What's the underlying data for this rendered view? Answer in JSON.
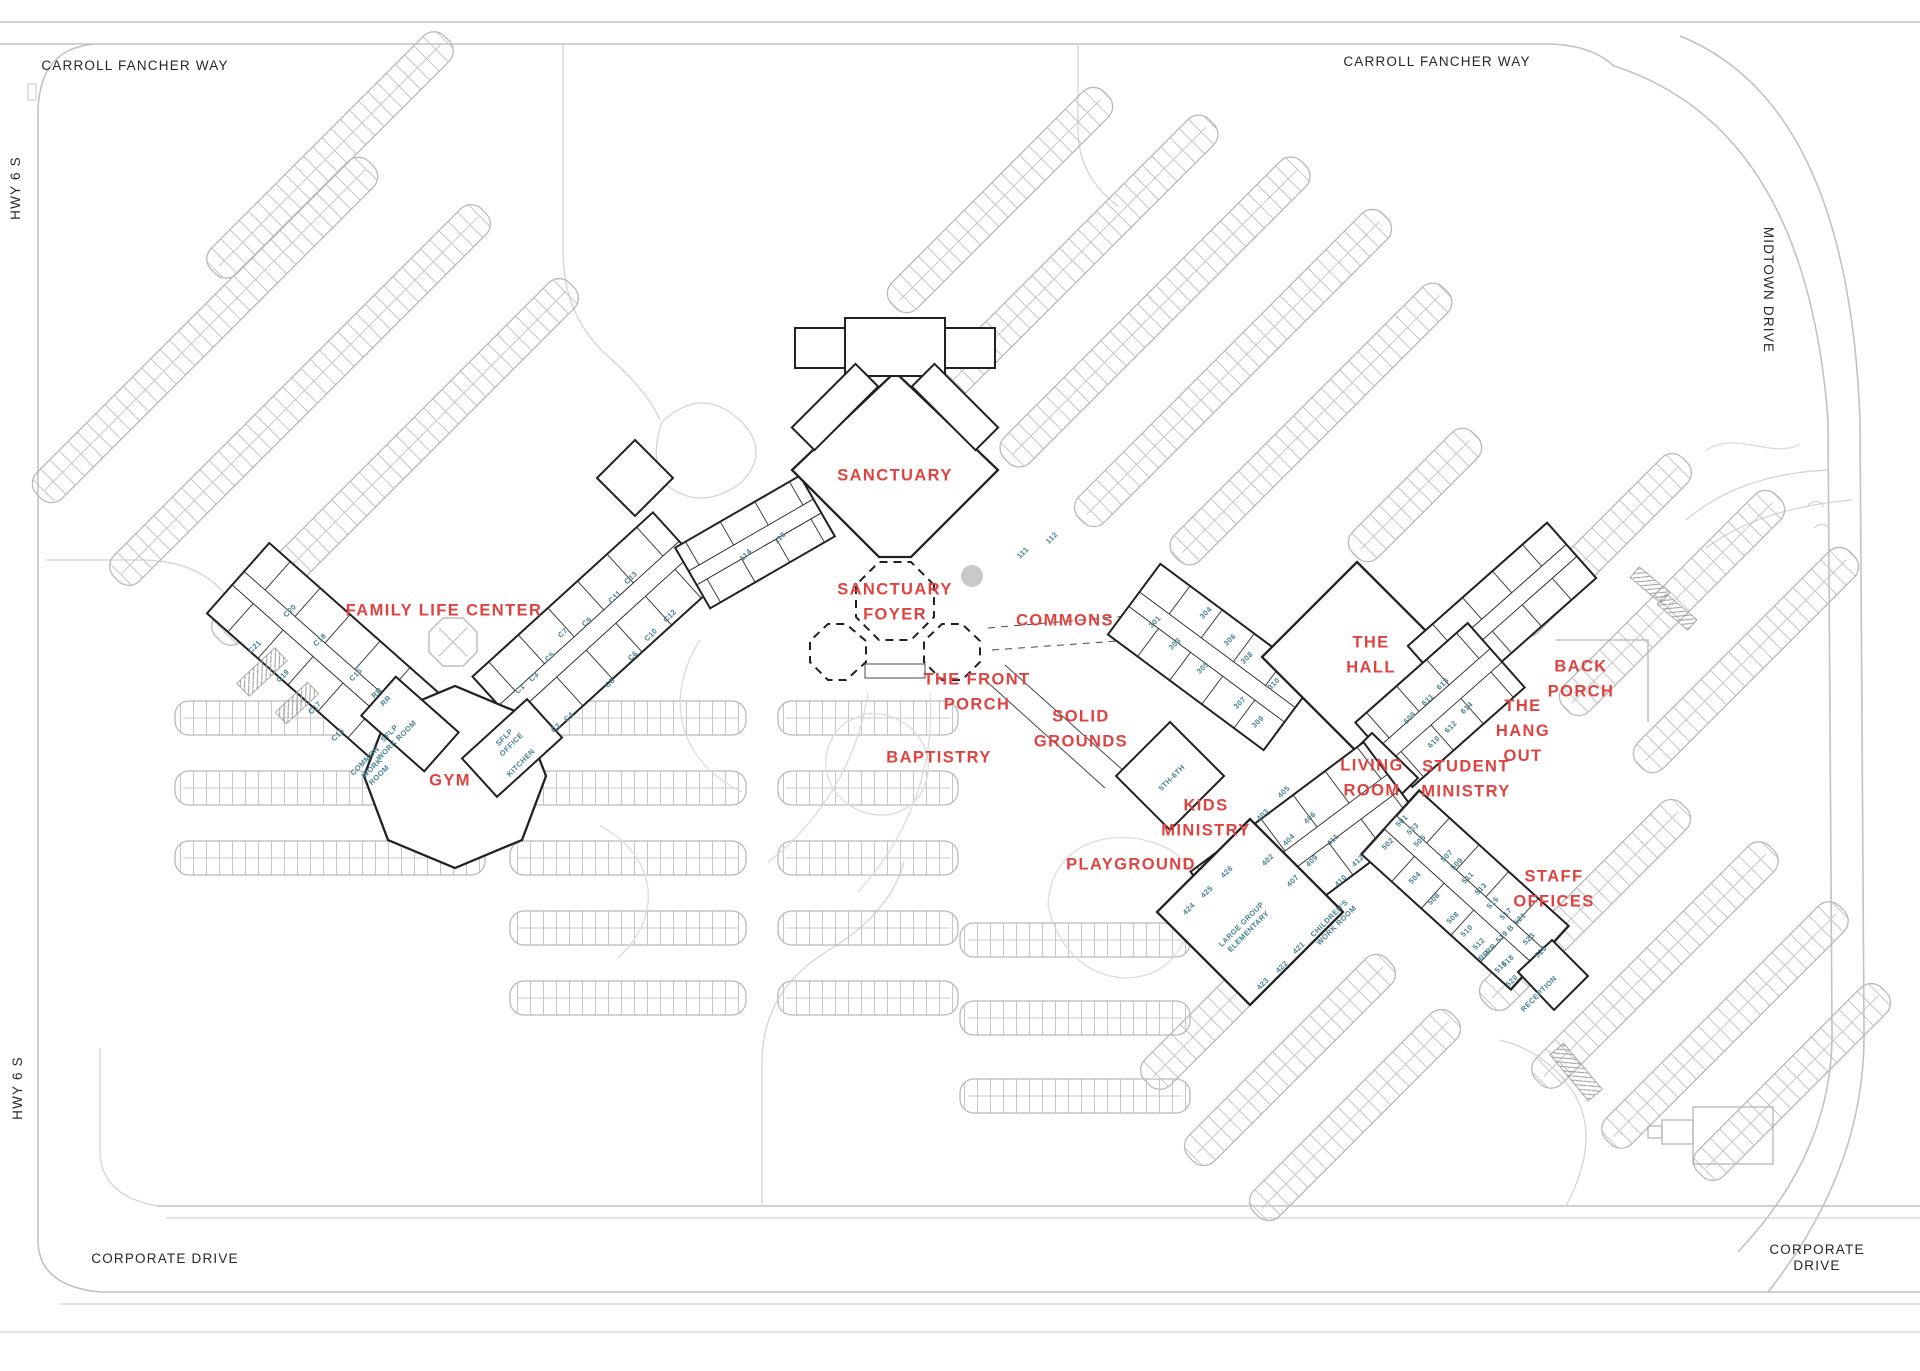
{
  "map_title": "Church Campus Site Plan",
  "colors": {
    "area_label": "#df4340",
    "room_label": "#47818f",
    "street_label": "#262626",
    "building_line": "#212121",
    "parking_line": "#b9b9b9",
    "road_line": "#c2c2c2"
  },
  "street_labels": [
    {
      "id": "carroll-fancher-way-west",
      "text": "CARROLL FANCHER WAY",
      "x": 135,
      "y": 66,
      "r": 0
    },
    {
      "id": "carroll-fancher-way-east",
      "text": "CARROLL FANCHER WAY",
      "x": 1437,
      "y": 62,
      "r": 0
    },
    {
      "id": "midtown-drive",
      "text": "MIDTOWN DRIVE",
      "x": 1768,
      "y": 290,
      "r": 90
    },
    {
      "id": "hwy-6-s-north",
      "text": "HWY 6 S",
      "x": 16,
      "y": 188,
      "r": -90
    },
    {
      "id": "hwy-6-s-south",
      "text": "HWY 6 S",
      "x": 18,
      "y": 1088,
      "r": -90
    },
    {
      "id": "corporate-drive-west",
      "text": "CORPORATE DRIVE",
      "x": 165,
      "y": 1259,
      "r": 0
    },
    {
      "id": "corporate-drive-east",
      "text": "CORPORATE DRIVE",
      "x": 1817,
      "y": 1258,
      "r": 0
    }
  ],
  "area_labels": [
    {
      "id": "sanctuary",
      "text": "SANCTUARY",
      "x": 895,
      "y": 476,
      "r": 0
    },
    {
      "id": "sanctuary-foyer",
      "text": "SANCTUARY\nFOYER",
      "x": 895,
      "y": 602,
      "r": 0
    },
    {
      "id": "family-life-center",
      "text": "FAMILY LIFE CENTER",
      "x": 444,
      "y": 611,
      "r": 0
    },
    {
      "id": "gym",
      "text": "GYM",
      "x": 450,
      "y": 781,
      "r": 0
    },
    {
      "id": "commons",
      "text": "COMMONS",
      "x": 1065,
      "y": 621,
      "r": 0
    },
    {
      "id": "the-front-porch",
      "text": "THE FRONT\nPORCH",
      "x": 977,
      "y": 692,
      "r": 0
    },
    {
      "id": "solid-grounds",
      "text": "SOLID\nGROUNDS",
      "x": 1081,
      "y": 729,
      "r": 0
    },
    {
      "id": "baptistry",
      "text": "BAPTISTRY",
      "x": 939,
      "y": 758,
      "r": 0
    },
    {
      "id": "kids-ministry",
      "text": "KIDS\nMINISTRY",
      "x": 1206,
      "y": 818,
      "r": 0
    },
    {
      "id": "playground",
      "text": "PLAYGROUND",
      "x": 1131,
      "y": 865,
      "r": 0
    },
    {
      "id": "the-hall",
      "text": "THE\nHALL",
      "x": 1371,
      "y": 655,
      "r": 0
    },
    {
      "id": "living-room",
      "text": "LIVING\nROOM",
      "x": 1372,
      "y": 778,
      "r": 0
    },
    {
      "id": "student-ministry",
      "text": "STUDENT\nMINISTRY",
      "x": 1466,
      "y": 779,
      "r": 0
    },
    {
      "id": "the-hang-out",
      "text": "THE\nHANG\nOUT",
      "x": 1523,
      "y": 731,
      "r": 0
    },
    {
      "id": "back-porch",
      "text": "BACK\nPORCH",
      "x": 1581,
      "y": 679,
      "r": 0
    },
    {
      "id": "staff-offices",
      "text": "STAFF\nOFFICES",
      "x": 1554,
      "y": 889,
      "r": 0
    }
  ],
  "room_labels": [
    {
      "id": "c20",
      "text": "C20",
      "x": 290,
      "y": 611,
      "r": -45
    },
    {
      "id": "c21",
      "text": "C21",
      "x": 255,
      "y": 647,
      "r": -45
    },
    {
      "id": "c18",
      "text": "C18",
      "x": 320,
      "y": 640,
      "r": -45
    },
    {
      "id": "c19",
      "text": "C19",
      "x": 283,
      "y": 676,
      "r": -45
    },
    {
      "id": "c16",
      "text": "C16",
      "x": 356,
      "y": 675,
      "r": -45
    },
    {
      "id": "c17",
      "text": "C17",
      "x": 315,
      "y": 708,
      "r": -45
    },
    {
      "id": "c15",
      "text": "C15",
      "x": 338,
      "y": 735,
      "r": -45
    },
    {
      "id": "rr-1",
      "text": "RR",
      "x": 377,
      "y": 693,
      "r": -45
    },
    {
      "id": "rr-2",
      "text": "RR",
      "x": 386,
      "y": 701,
      "r": -45
    },
    {
      "id": "sflp-work-room",
      "text": "SFLP\nWORK ROOM",
      "x": 393,
      "y": 737,
      "r": -45
    },
    {
      "id": "common-work-room",
      "text": "COMMON\nWORK\nROOM",
      "x": 372,
      "y": 768,
      "r": -45
    },
    {
      "id": "sflp-office",
      "text": "SFLP\nOFFICE",
      "x": 508,
      "y": 741,
      "r": -45
    },
    {
      "id": "kitchen",
      "text": "KITCHEN",
      "x": 521,
      "y": 763,
      "r": -45
    },
    {
      "id": "c13",
      "text": "C13",
      "x": 631,
      "y": 578,
      "r": -45
    },
    {
      "id": "c11",
      "text": "C11",
      "x": 615,
      "y": 597,
      "r": -45
    },
    {
      "id": "c9",
      "text": "C9",
      "x": 587,
      "y": 622,
      "r": -45
    },
    {
      "id": "c7",
      "text": "C7",
      "x": 563,
      "y": 633,
      "r": -45
    },
    {
      "id": "c5",
      "text": "C5",
      "x": 550,
      "y": 657,
      "r": -45
    },
    {
      "id": "c3",
      "text": "C3",
      "x": 534,
      "y": 677,
      "r": -45
    },
    {
      "id": "c1",
      "text": "C1",
      "x": 520,
      "y": 689,
      "r": -45
    },
    {
      "id": "c12",
      "text": "C12",
      "x": 670,
      "y": 616,
      "r": -45
    },
    {
      "id": "c10",
      "text": "C10",
      "x": 651,
      "y": 635,
      "r": -45
    },
    {
      "id": "c8",
      "text": "C8",
      "x": 610,
      "y": 683,
      "r": -45
    },
    {
      "id": "c6",
      "text": "C6",
      "x": 633,
      "y": 656,
      "r": -45
    },
    {
      "id": "c4",
      "text": "C4",
      "x": 569,
      "y": 717,
      "r": -45
    },
    {
      "id": "c2",
      "text": "C2",
      "x": 556,
      "y": 728,
      "r": -45
    },
    {
      "id": "room-113",
      "text": "113",
      "x": 780,
      "y": 538,
      "r": -45
    },
    {
      "id": "room-114",
      "text": "114",
      "x": 746,
      "y": 555,
      "r": -45
    },
    {
      "id": "room-111",
      "text": "111",
      "x": 1023,
      "y": 553,
      "r": -45
    },
    {
      "id": "room-112",
      "text": "112",
      "x": 1052,
      "y": 538,
      "r": -45
    },
    {
      "id": "room-301",
      "text": "301",
      "x": 1155,
      "y": 622,
      "r": -45
    },
    {
      "id": "room-303",
      "text": "303",
      "x": 1175,
      "y": 644,
      "r": -45
    },
    {
      "id": "room-305",
      "text": "305",
      "x": 1203,
      "y": 668,
      "r": -45
    },
    {
      "id": "room-307",
      "text": "307",
      "x": 1240,
      "y": 703,
      "r": -45
    },
    {
      "id": "room-309",
      "text": "309",
      "x": 1258,
      "y": 722,
      "r": -45
    },
    {
      "id": "room-304",
      "text": "304",
      "x": 1206,
      "y": 613,
      "r": -45
    },
    {
      "id": "room-306",
      "text": "306",
      "x": 1230,
      "y": 640,
      "r": -45
    },
    {
      "id": "room-308",
      "text": "308",
      "x": 1247,
      "y": 658,
      "r": -45
    },
    {
      "id": "room-310",
      "text": "310",
      "x": 1274,
      "y": 684,
      "r": -45
    },
    {
      "id": "room-609",
      "text": "609",
      "x": 1410,
      "y": 718,
      "r": -45
    },
    {
      "id": "room-611",
      "text": "611",
      "x": 1428,
      "y": 700,
      "r": -45
    },
    {
      "id": "room-613",
      "text": "613",
      "x": 1443,
      "y": 684,
      "r": -45
    },
    {
      "id": "room-610",
      "text": "610",
      "x": 1434,
      "y": 742,
      "r": -45
    },
    {
      "id": "room-612",
      "text": "612",
      "x": 1451,
      "y": 727,
      "r": -45
    },
    {
      "id": "room-614",
      "text": "614",
      "x": 1467,
      "y": 708,
      "r": -45
    },
    {
      "id": "room-5th-6th",
      "text": "5TH-6TH",
      "x": 1172,
      "y": 778,
      "r": -45
    },
    {
      "id": "room-405",
      "text": "405",
      "x": 1284,
      "y": 792,
      "r": -45
    },
    {
      "id": "room-403",
      "text": "403",
      "x": 1263,
      "y": 815,
      "r": -45
    },
    {
      "id": "room-402",
      "text": "402",
      "x": 1268,
      "y": 860,
      "r": -45
    },
    {
      "id": "room-404",
      "text": "404",
      "x": 1289,
      "y": 840,
      "r": -45
    },
    {
      "id": "room-406",
      "text": "406",
      "x": 1310,
      "y": 818,
      "r": -45
    },
    {
      "id": "room-407",
      "text": "407",
      "x": 1293,
      "y": 881,
      "r": -45
    },
    {
      "id": "room-409",
      "text": "409",
      "x": 1312,
      "y": 861,
      "r": -45
    },
    {
      "id": "room-411",
      "text": "411",
      "x": 1333,
      "y": 840,
      "r": -45
    },
    {
      "id": "room-410",
      "text": "410",
      "x": 1341,
      "y": 881,
      "r": -45
    },
    {
      "id": "room-412",
      "text": "412",
      "x": 1358,
      "y": 861,
      "r": -45
    },
    {
      "id": "room-426",
      "text": "426",
      "x": 1227,
      "y": 872,
      "r": -45
    },
    {
      "id": "room-425",
      "text": "425",
      "x": 1207,
      "y": 892,
      "r": -45
    },
    {
      "id": "room-424",
      "text": "424",
      "x": 1189,
      "y": 909,
      "r": -45
    },
    {
      "id": "room-421",
      "text": "421",
      "x": 1299,
      "y": 948,
      "r": -45
    },
    {
      "id": "room-422",
      "text": "422",
      "x": 1282,
      "y": 967,
      "r": -45
    },
    {
      "id": "room-423",
      "text": "423",
      "x": 1263,
      "y": 984,
      "r": -45
    },
    {
      "id": "large-group-elementary",
      "text": "LARGE GROUP\nELEMENTARY",
      "x": 1245,
      "y": 928,
      "r": -45
    },
    {
      "id": "childrens-work-room",
      "text": "CHILDREN'S\nWORK ROOM",
      "x": 1333,
      "y": 922,
      "r": -45
    },
    {
      "id": "room-501",
      "text": "501",
      "x": 1402,
      "y": 821,
      "r": -45
    },
    {
      "id": "room-503",
      "text": "503",
      "x": 1413,
      "y": 829,
      "r": -45
    },
    {
      "id": "room-505",
      "text": "505",
      "x": 1420,
      "y": 841,
      "r": -45
    },
    {
      "id": "room-502",
      "text": "502",
      "x": 1388,
      "y": 844,
      "r": -45
    },
    {
      "id": "room-504",
      "text": "504",
      "x": 1415,
      "y": 878,
      "r": -45
    },
    {
      "id": "room-506",
      "text": "506",
      "x": 1434,
      "y": 899,
      "r": -45
    },
    {
      "id": "room-507",
      "text": "507",
      "x": 1447,
      "y": 856,
      "r": -45
    },
    {
      "id": "room-509",
      "text": "509",
      "x": 1457,
      "y": 864,
      "r": -45
    },
    {
      "id": "room-511",
      "text": "511",
      "x": 1468,
      "y": 878,
      "r": -45
    },
    {
      "id": "room-513",
      "text": "513",
      "x": 1481,
      "y": 889,
      "r": -45
    },
    {
      "id": "room-515",
      "text": "515",
      "x": 1493,
      "y": 903,
      "r": -45
    },
    {
      "id": "room-517",
      "text": "517",
      "x": 1506,
      "y": 914,
      "r": -45
    },
    {
      "id": "room-519b",
      "text": "519 B",
      "x": 1505,
      "y": 934,
      "r": -45
    },
    {
      "id": "room-521",
      "text": "521",
      "x": 1520,
      "y": 919,
      "r": -45
    },
    {
      "id": "room-523",
      "text": "523",
      "x": 1529,
      "y": 939,
      "r": -45
    },
    {
      "id": "room-525",
      "text": "525",
      "x": 1541,
      "y": 952,
      "r": -45
    },
    {
      "id": "room-508",
      "text": "508",
      "x": 1453,
      "y": 918,
      "r": -45
    },
    {
      "id": "room-510",
      "text": "510",
      "x": 1467,
      "y": 931,
      "r": -45
    },
    {
      "id": "room-512",
      "text": "512",
      "x": 1479,
      "y": 944,
      "r": -45
    },
    {
      "id": "rr-3",
      "text": "RR",
      "x": 1484,
      "y": 956,
      "r": -45
    },
    {
      "id": "rr-4",
      "text": "RR",
      "x": 1491,
      "y": 949,
      "r": -45
    },
    {
      "id": "room-516",
      "text": "516",
      "x": 1501,
      "y": 967,
      "r": -45
    },
    {
      "id": "room-518",
      "text": "518",
      "x": 1508,
      "y": 961,
      "r": -45
    },
    {
      "id": "room-520",
      "text": "520",
      "x": 1512,
      "y": 981,
      "r": -45
    },
    {
      "id": "reception",
      "text": "RECEPTION",
      "x": 1539,
      "y": 994,
      "r": -45
    }
  ]
}
